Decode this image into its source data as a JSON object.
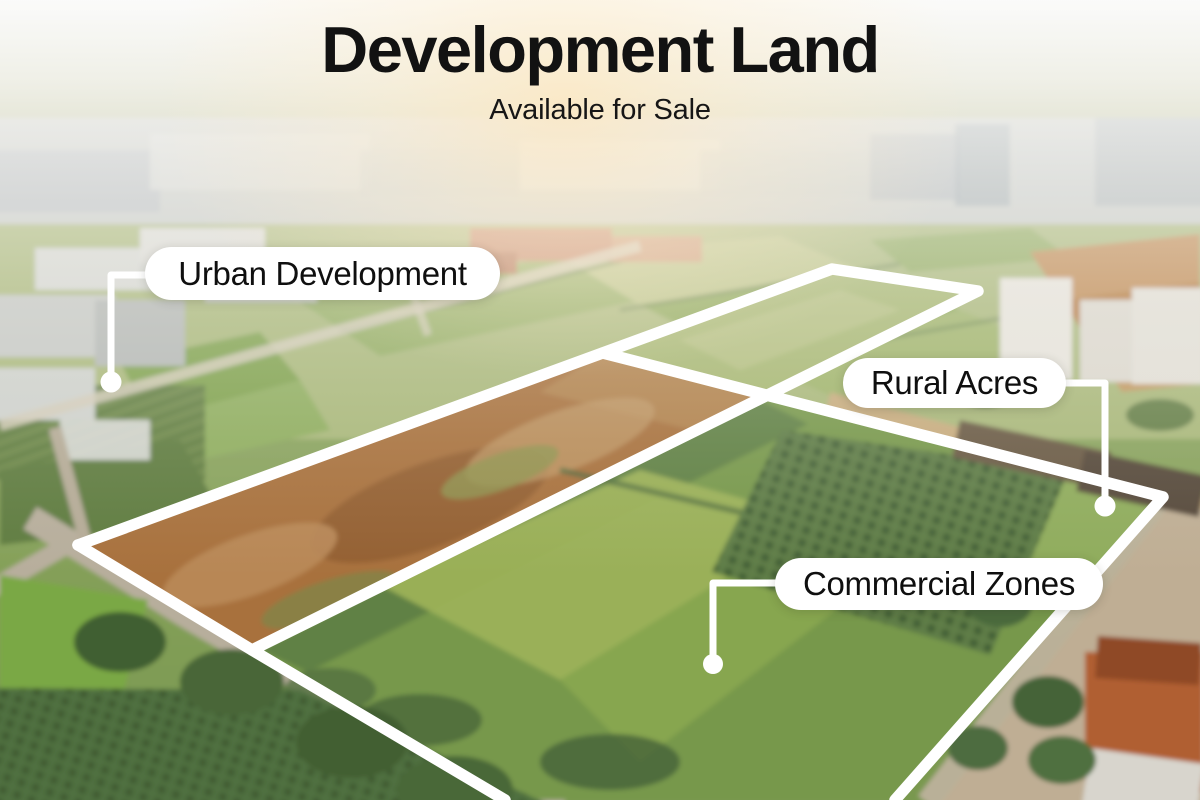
{
  "header": {
    "title": "Development Land",
    "subtitle": "Available for Sale"
  },
  "callouts": [
    {
      "id": "urban",
      "label": "Urban Development"
    },
    {
      "id": "rural",
      "label": "Rural Acres"
    },
    {
      "id": "commercial",
      "label": "Commercial Zones"
    }
  ],
  "colors": {
    "title_text": "#121212",
    "callout_bg": "#ffffff",
    "callout_text": "#0f0f0f",
    "parcel_outline": "#ffffff"
  }
}
